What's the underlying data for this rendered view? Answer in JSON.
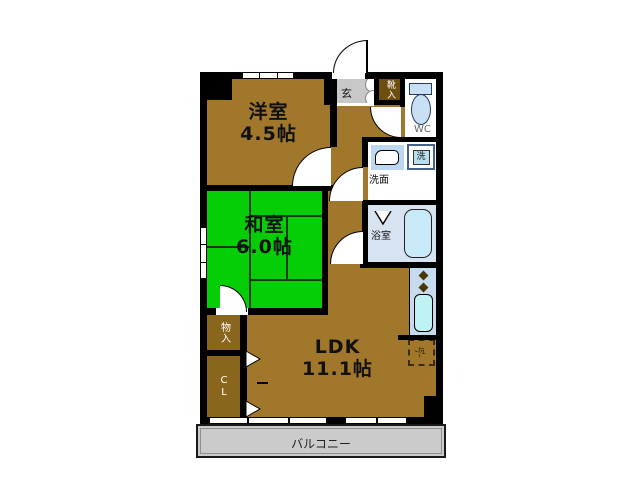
{
  "palette": {
    "floor_brown": "#A1782B",
    "closet_brown": "#8A651E",
    "shoe_cabinet_brown": "#6E4E0E",
    "tatami_green": "#06CE06",
    "entrance_gray": "#C8C8C8",
    "balcony_gray": "#CBCBCB",
    "fixture_blue": "#C9DFF4",
    "bathroom_blue": "#D7E3F0",
    "wall_black": "#000000"
  },
  "rooms": {
    "western": {
      "name": "洋室",
      "size": "4.5帖"
    },
    "japanese": {
      "name": "和室",
      "size": "6.0帖"
    },
    "ldk": {
      "name": "LDK",
      "size": "11.1帖"
    },
    "toilet": {
      "label": "WC"
    },
    "washroom": {
      "label": "洗面"
    },
    "washer": {
      "label": "洗"
    },
    "bathroom": {
      "label": "浴室"
    },
    "entrance": {
      "label": "玄"
    },
    "shoe_cabinet": {
      "label": "靴入"
    },
    "storage": {
      "label": "物入"
    },
    "closet": {
      "label": "CL"
    },
    "refrigerator": {
      "label": "冷"
    },
    "balcony": {
      "label": "バルコニー"
    }
  }
}
